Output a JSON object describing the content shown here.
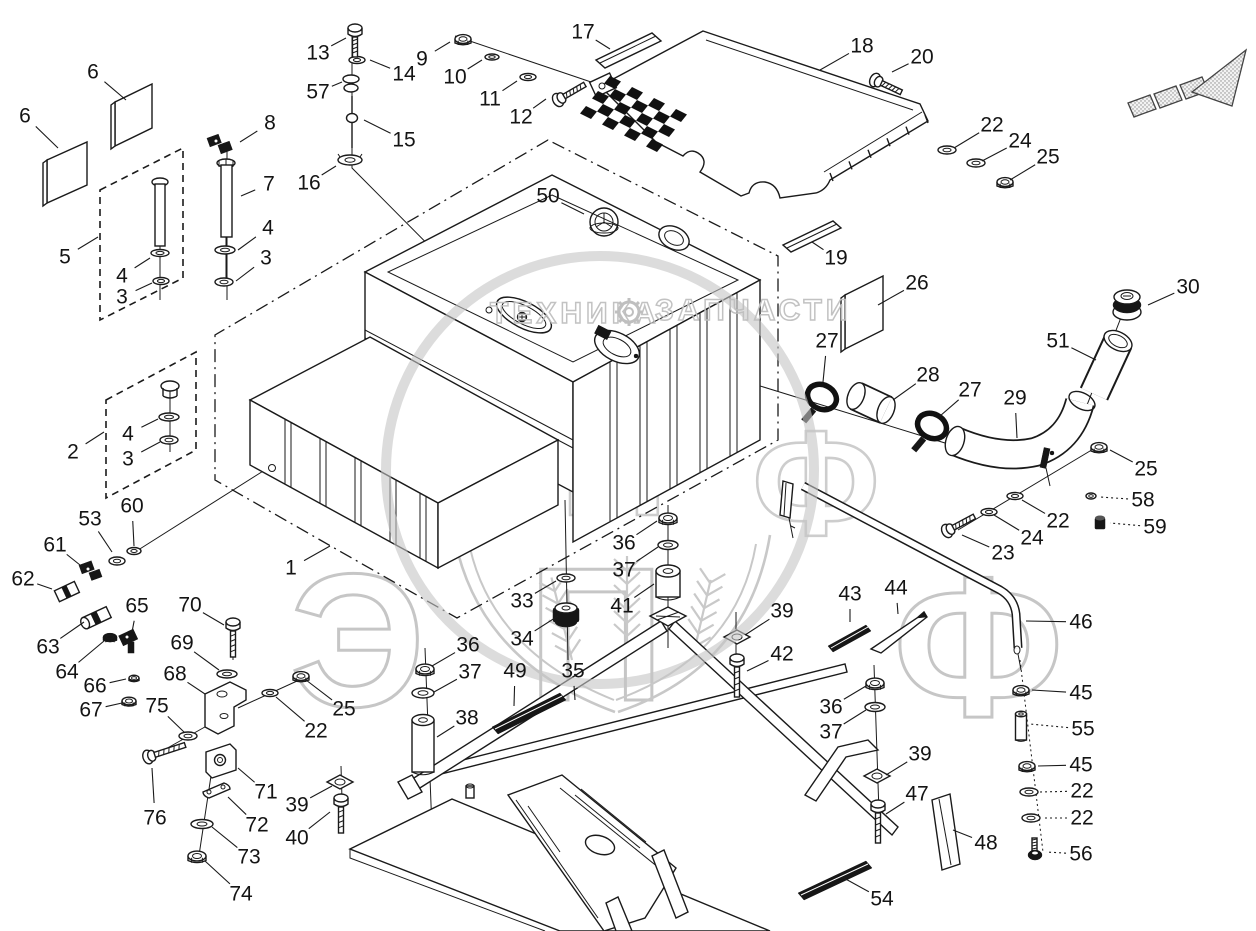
{
  "document": {
    "type": "exploded-parts-diagram",
    "subject": "fuel tank assembly"
  },
  "colors": {
    "line": "#1a1a1a",
    "background": "#ffffff",
    "watermark": "#c8c8c8"
  },
  "watermark": {
    "title_left": "ТЕХНИКА",
    "title_right": "ЗАПЧАСТИ",
    "big_letters": "ЭПФ",
    "letter1": "Э",
    "letter2": "П",
    "letter3": "Ф"
  },
  "callouts": [
    {
      "n": "6",
      "x": 93,
      "y": 72,
      "lx": 126,
      "ly": 100
    },
    {
      "n": "6",
      "x": 25,
      "y": 116,
      "lx": 58,
      "ly": 148
    },
    {
      "n": "13",
      "x": 318,
      "y": 53,
      "lx": 346,
      "ly": 38
    },
    {
      "n": "14",
      "x": 404,
      "y": 74,
      "lx": 370,
      "ly": 60
    },
    {
      "n": "57",
      "x": 318,
      "y": 92,
      "lx": 342,
      "ly": 82
    },
    {
      "n": "15",
      "x": 404,
      "y": 140,
      "lx": 364,
      "ly": 120
    },
    {
      "n": "16",
      "x": 309,
      "y": 183,
      "lx": 336,
      "ly": 166
    },
    {
      "n": "8",
      "x": 270,
      "y": 123,
      "lx": 240,
      "ly": 142
    },
    {
      "n": "7",
      "x": 269,
      "y": 184,
      "lx": 241,
      "ly": 196
    },
    {
      "n": "4",
      "x": 268,
      "y": 228,
      "lx": 238,
      "ly": 250
    },
    {
      "n": "3",
      "x": 266,
      "y": 258,
      "lx": 236,
      "ly": 281
    },
    {
      "n": "5",
      "x": 65,
      "y": 257,
      "lx": 98,
      "ly": 237
    },
    {
      "n": "4",
      "x": 122,
      "y": 276,
      "lx": 150,
      "ly": 258
    },
    {
      "n": "3",
      "x": 122,
      "y": 297,
      "lx": 152,
      "ly": 283
    },
    {
      "n": "9",
      "x": 422,
      "y": 59,
      "lx": 450,
      "ly": 42
    },
    {
      "n": "10",
      "x": 455,
      "y": 77,
      "lx": 482,
      "ly": 60
    },
    {
      "n": "11",
      "x": 490,
      "y": 99,
      "lx": 517,
      "ly": 81
    },
    {
      "n": "12",
      "x": 521,
      "y": 117,
      "lx": 546,
      "ly": 99
    },
    {
      "n": "17",
      "x": 583,
      "y": 32,
      "lx": 610,
      "ly": 49
    },
    {
      "n": "18",
      "x": 862,
      "y": 46,
      "lx": 820,
      "ly": 70
    },
    {
      "n": "20",
      "x": 922,
      "y": 57,
      "lx": 892,
      "ly": 72
    },
    {
      "n": "22",
      "x": 992,
      "y": 125,
      "lx": 954,
      "ly": 148
    },
    {
      "n": "24",
      "x": 1020,
      "y": 141,
      "lx": 982,
      "ly": 161
    },
    {
      "n": "25",
      "x": 1048,
      "y": 157,
      "lx": 1010,
      "ly": 180
    },
    {
      "n": "19",
      "x": 836,
      "y": 258,
      "lx": 812,
      "ly": 242
    },
    {
      "n": "26",
      "x": 917,
      "y": 283,
      "lx": 878,
      "ly": 305
    },
    {
      "n": "50",
      "x": 548,
      "y": 196,
      "lx": 584,
      "ly": 214
    },
    {
      "n": "30",
      "x": 1188,
      "y": 287,
      "lx": 1148,
      "ly": 305
    },
    {
      "n": "51",
      "x": 1058,
      "y": 341,
      "lx": 1096,
      "ly": 360
    },
    {
      "n": "27",
      "x": 827,
      "y": 341,
      "lx": 823,
      "ly": 382
    },
    {
      "n": "28",
      "x": 928,
      "y": 375,
      "lx": 893,
      "ly": 400
    },
    {
      "n": "27",
      "x": 970,
      "y": 390,
      "lx": 940,
      "ly": 416
    },
    {
      "n": "29",
      "x": 1015,
      "y": 398,
      "lx": 1017,
      "ly": 438
    },
    {
      "n": "25",
      "x": 1146,
      "y": 469,
      "lx": 1110,
      "ly": 450
    },
    {
      "n": "58",
      "x": 1143,
      "y": 500,
      "lx": 1100,
      "ly": 497,
      "d": 1
    },
    {
      "n": "22",
      "x": 1058,
      "y": 521,
      "lx": 1022,
      "ly": 500
    },
    {
      "n": "59",
      "x": 1155,
      "y": 527,
      "lx": 1110,
      "ly": 523,
      "d": 1
    },
    {
      "n": "24",
      "x": 1032,
      "y": 538,
      "lx": 994,
      "ly": 515
    },
    {
      "n": "23",
      "x": 1003,
      "y": 553,
      "lx": 962,
      "ly": 535
    },
    {
      "n": "2",
      "x": 73,
      "y": 452,
      "lx": 104,
      "ly": 432
    },
    {
      "n": "4",
      "x": 128,
      "y": 434,
      "lx": 158,
      "ly": 419
    },
    {
      "n": "3",
      "x": 128,
      "y": 459,
      "lx": 160,
      "ly": 442
    },
    {
      "n": "1",
      "x": 291,
      "y": 568,
      "lx": 330,
      "ly": 546
    },
    {
      "n": "60",
      "x": 132,
      "y": 506,
      "lx": 134,
      "ly": 546
    },
    {
      "n": "53",
      "x": 90,
      "y": 519,
      "lx": 112,
      "ly": 552
    },
    {
      "n": "61",
      "x": 55,
      "y": 545,
      "lx": 80,
      "ly": 565
    },
    {
      "n": "62",
      "x": 23,
      "y": 579,
      "lx": 52,
      "ly": 589
    },
    {
      "n": "63",
      "x": 48,
      "y": 647,
      "lx": 84,
      "ly": 622
    },
    {
      "n": "64",
      "x": 67,
      "y": 672,
      "lx": 104,
      "ly": 641
    },
    {
      "n": "65",
      "x": 137,
      "y": 606,
      "lx": 132,
      "ly": 632
    },
    {
      "n": "66",
      "x": 95,
      "y": 686,
      "lx": 126,
      "ly": 679
    },
    {
      "n": "67",
      "x": 91,
      "y": 710,
      "lx": 122,
      "ly": 703
    },
    {
      "n": "70",
      "x": 190,
      "y": 605,
      "lx": 224,
      "ly": 625
    },
    {
      "n": "69",
      "x": 182,
      "y": 643,
      "lx": 219,
      "ly": 670
    },
    {
      "n": "68",
      "x": 175,
      "y": 674,
      "lx": 205,
      "ly": 694
    },
    {
      "n": "25",
      "x": 344,
      "y": 709,
      "lx": 306,
      "ly": 680
    },
    {
      "n": "22",
      "x": 316,
      "y": 731,
      "lx": 276,
      "ly": 697
    },
    {
      "n": "75",
      "x": 157,
      "y": 706,
      "lx": 184,
      "ly": 732
    },
    {
      "n": "76",
      "x": 155,
      "y": 818,
      "lx": 152,
      "ly": 768
    },
    {
      "n": "71",
      "x": 266,
      "y": 792,
      "lx": 238,
      "ly": 768
    },
    {
      "n": "72",
      "x": 257,
      "y": 825,
      "lx": 228,
      "ly": 797
    },
    {
      "n": "73",
      "x": 249,
      "y": 857,
      "lx": 212,
      "ly": 827
    },
    {
      "n": "74",
      "x": 241,
      "y": 894,
      "lx": 205,
      "ly": 861
    },
    {
      "n": "39",
      "x": 297,
      "y": 805,
      "lx": 332,
      "ly": 786
    },
    {
      "n": "40",
      "x": 297,
      "y": 838,
      "lx": 330,
      "ly": 812
    },
    {
      "n": "36",
      "x": 468,
      "y": 645,
      "lx": 432,
      "ly": 666
    },
    {
      "n": "37",
      "x": 470,
      "y": 672,
      "lx": 434,
      "ly": 692
    },
    {
      "n": "38",
      "x": 467,
      "y": 718,
      "lx": 437,
      "ly": 737
    },
    {
      "n": "49",
      "x": 515,
      "y": 671,
      "lx": 514,
      "ly": 706
    },
    {
      "n": "35",
      "x": 573,
      "y": 671,
      "lx": 575,
      "ly": 700
    },
    {
      "n": "33",
      "x": 522,
      "y": 601,
      "lx": 556,
      "ly": 581
    },
    {
      "n": "34",
      "x": 522,
      "y": 639,
      "lx": 558,
      "ly": 616
    },
    {
      "n": "36",
      "x": 624,
      "y": 543,
      "lx": 657,
      "ly": 521
    },
    {
      "n": "37",
      "x": 624,
      "y": 570,
      "lx": 658,
      "ly": 547
    },
    {
      "n": "41",
      "x": 622,
      "y": 606,
      "lx": 654,
      "ly": 584
    },
    {
      "n": "39",
      "x": 782,
      "y": 611,
      "lx": 745,
      "ly": 635
    },
    {
      "n": "42",
      "x": 782,
      "y": 654,
      "lx": 747,
      "ly": 671
    },
    {
      "n": "36",
      "x": 831,
      "y": 707,
      "lx": 866,
      "ly": 686
    },
    {
      "n": "37",
      "x": 831,
      "y": 732,
      "lx": 866,
      "ly": 710
    },
    {
      "n": "39",
      "x": 920,
      "y": 754,
      "lx": 886,
      "ly": 775
    },
    {
      "n": "47",
      "x": 917,
      "y": 794,
      "lx": 886,
      "ly": 814
    },
    {
      "n": "48",
      "x": 986,
      "y": 843,
      "lx": 953,
      "ly": 830
    },
    {
      "n": "54",
      "x": 882,
      "y": 899,
      "lx": 842,
      "ly": 877
    },
    {
      "n": "43",
      "x": 850,
      "y": 594,
      "lx": 850,
      "ly": 622
    },
    {
      "n": "44",
      "x": 896,
      "y": 588,
      "lx": 898,
      "ly": 614
    },
    {
      "n": "46",
      "x": 1081,
      "y": 622,
      "lx": 1026,
      "ly": 621
    },
    {
      "n": "45",
      "x": 1081,
      "y": 693,
      "lx": 1032,
      "ly": 690
    },
    {
      "n": "55",
      "x": 1083,
      "y": 729,
      "lx": 1030,
      "ly": 724,
      "d": 1
    },
    {
      "n": "45",
      "x": 1081,
      "y": 765,
      "lx": 1038,
      "ly": 766
    },
    {
      "n": "22",
      "x": 1082,
      "y": 791,
      "lx": 1040,
      "ly": 792,
      "d": 1
    },
    {
      "n": "22",
      "x": 1082,
      "y": 818,
      "lx": 1042,
      "ly": 818,
      "d": 1
    },
    {
      "n": "56",
      "x": 1081,
      "y": 854,
      "lx": 1046,
      "ly": 852,
      "d": 1
    }
  ]
}
